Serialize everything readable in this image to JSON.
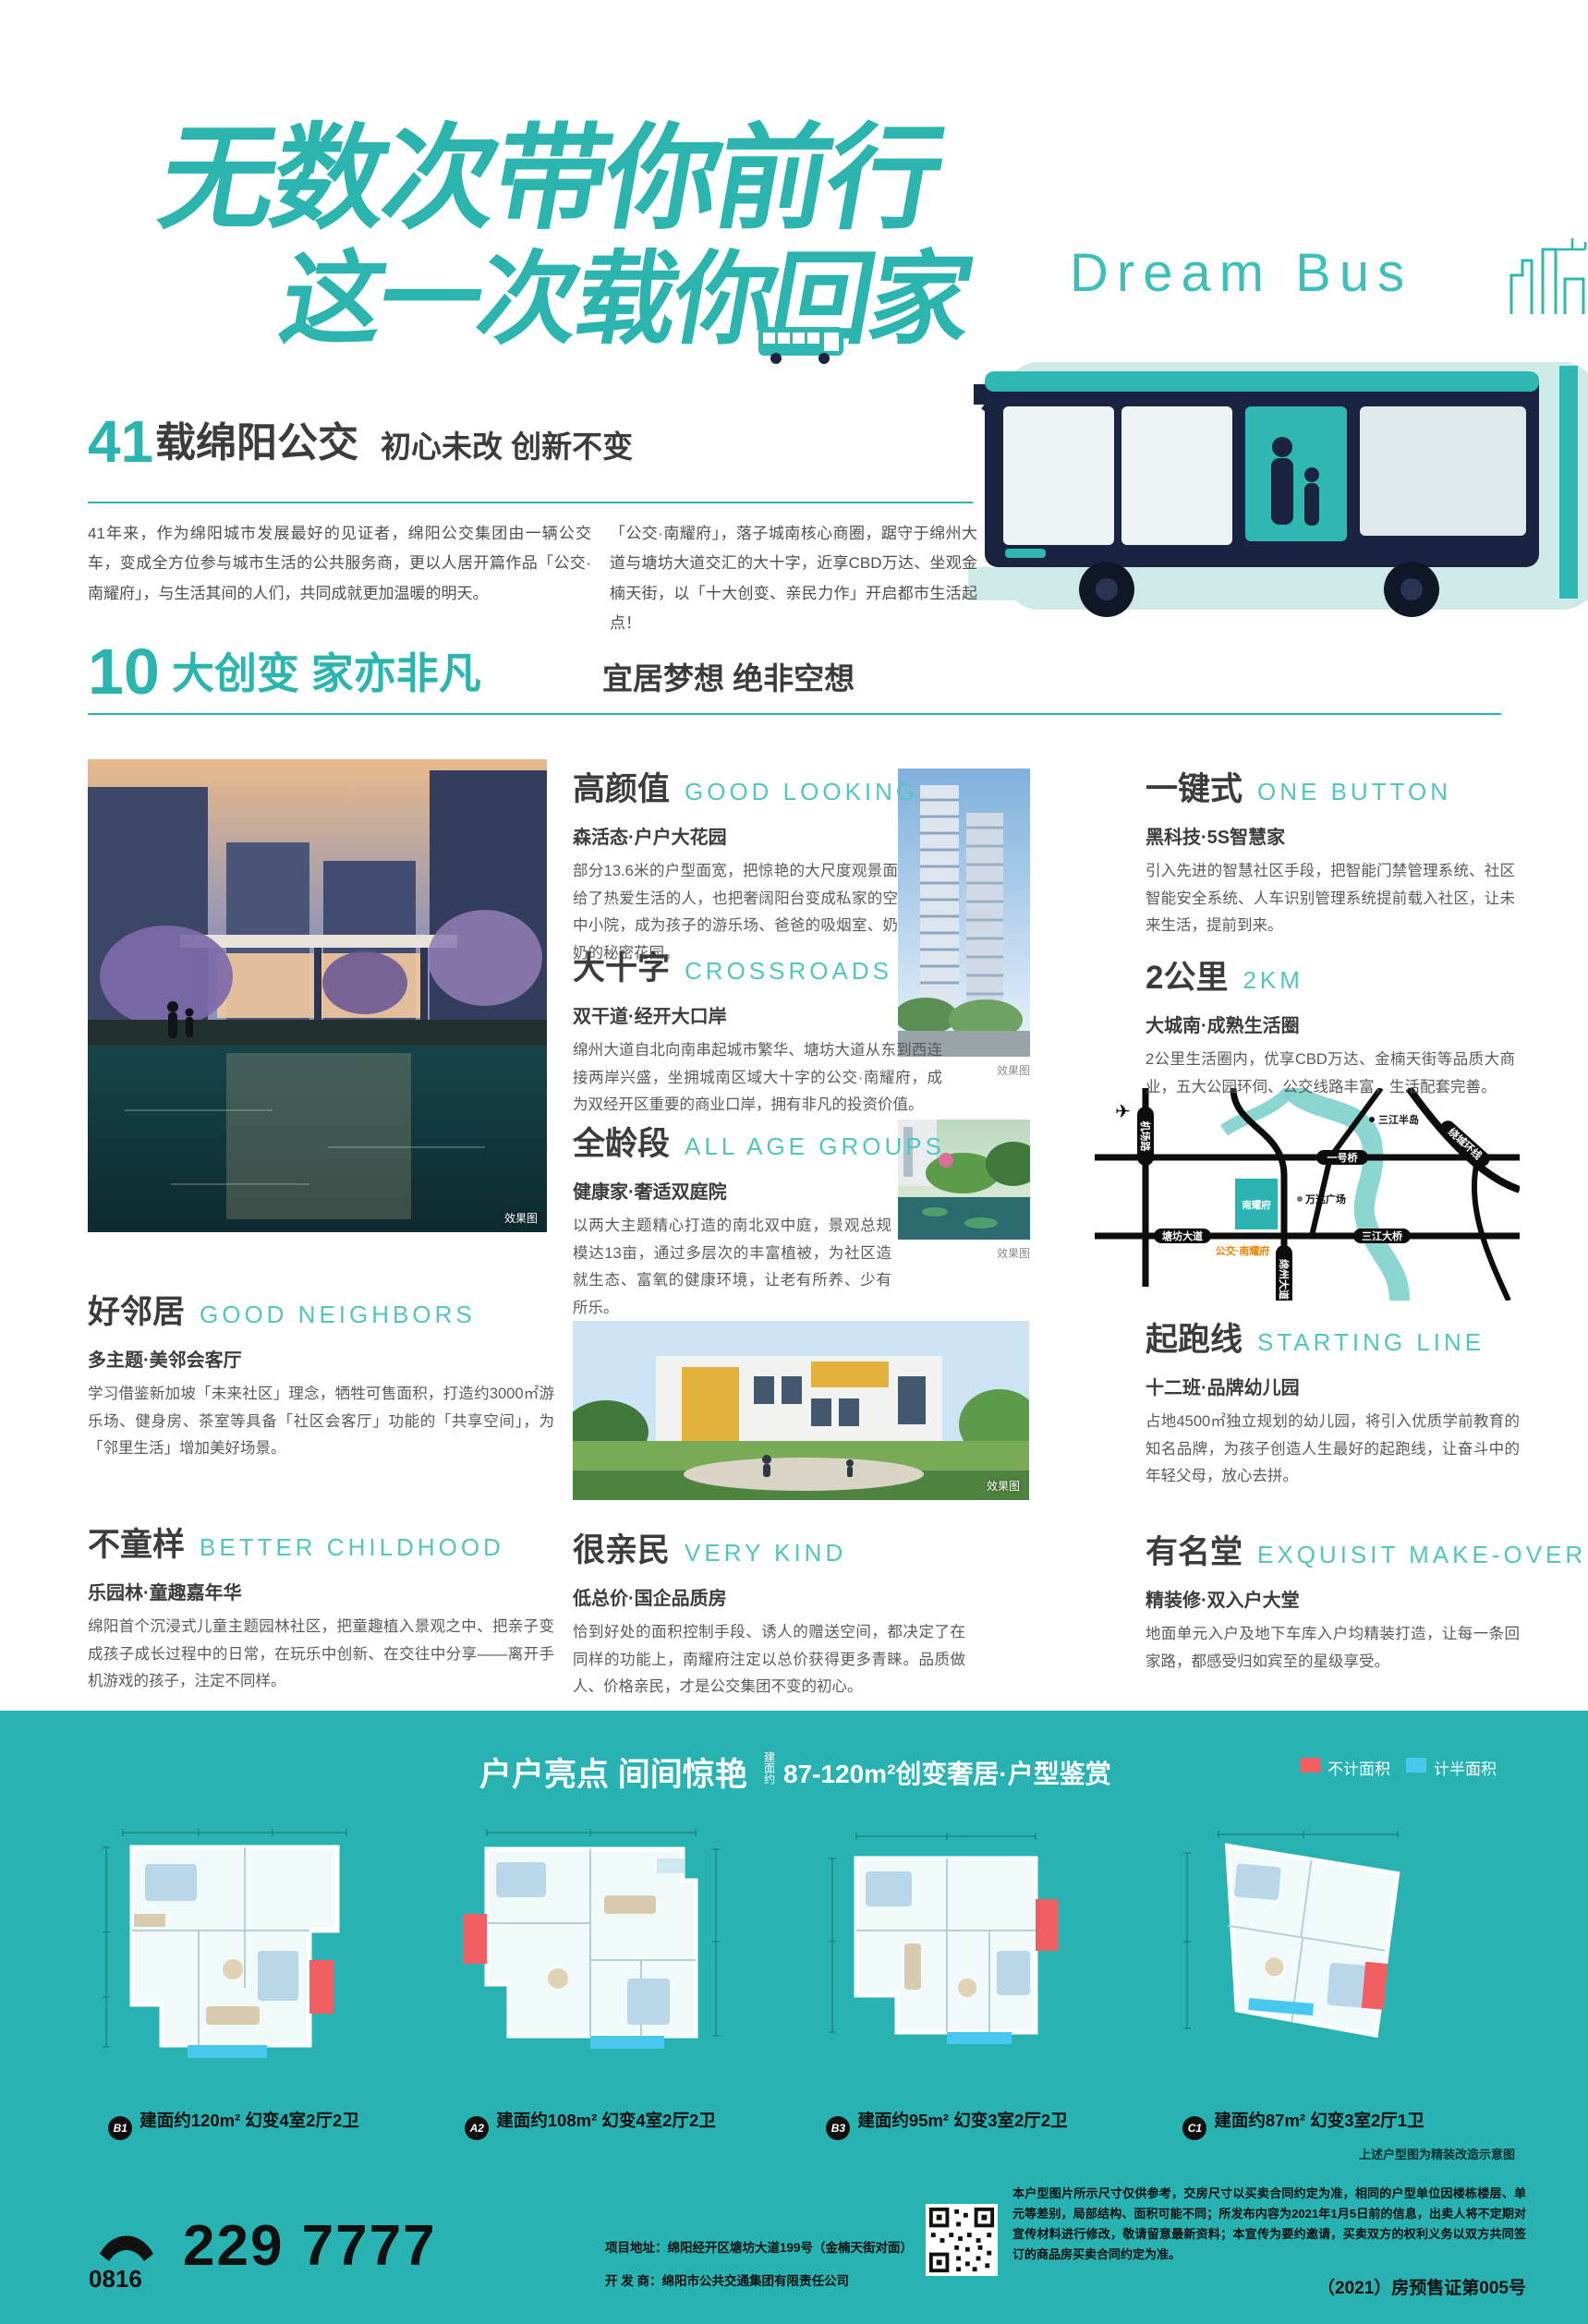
{
  "colors": {
    "teal": "#2BB5AE",
    "band_teal": "#29B2B2",
    "bus_navy": "#1A2440",
    "mint": "#CDEAE8",
    "legend_red": "#F25F63",
    "legend_cyan": "#49C8EF",
    "map_orange": "#F08300"
  },
  "icons": {
    "bus_small": "bus-icon",
    "bus_big": "dream-bus-illustration",
    "skyline": "city-skyline-icon",
    "plane": "airplane-icon",
    "phone": "phone-icon",
    "qr": "qr-code"
  },
  "hero": {
    "line1": "无数次带你前行",
    "line2": "这一次载你回家",
    "dream_bus": "Dream Bus"
  },
  "s41": {
    "num": "41",
    "title": "载绵阳公交",
    "subtitle": "初心未改 创新不变",
    "para_left": "41年来，作为绵阳城市发展最好的见证者，绵阳公交集团由一辆公交车，变成全方位参与城市生活的公共服务商，更以人居开篇作品「公交·南耀府」，与生活其间的人们，共同成就更加温暖的明天。",
    "para_right": "「公交·南耀府」，落子城南核心商圈，踞守于绵州大道与塘坊大道交汇的大十字，近享CBD万达、坐观金楠天街，以「十大创变、亲民力作」开启都市生活起点！"
  },
  "s10": {
    "num": "10",
    "title": "大创变  家亦非凡",
    "subtitle": "宜居梦想  绝非空想"
  },
  "captions": {
    "render": "效果图"
  },
  "features": [
    {
      "cn": "高颜值",
      "en": "GOOD  LOOKING",
      "sub": "森活态·户户大花园",
      "body": "部分13.6米的户型面宽，把惊艳的大尺度观景面给了热爱生活的人，也把奢阔阳台变成私家的空中小院，成为孩子的游乐场、爸爸的吸烟室、奶奶的秘密花园。"
    },
    {
      "cn": "大十字",
      "en": "CROSSROADS",
      "sub": "双干道·经开大口岸",
      "body": "绵州大道自北向南串起城市繁华、塘坊大道从东到西连接两岸兴盛，坐拥城南区域大十字的公交·南耀府，成为双经开区重要的商业口岸，拥有非凡的投资价值。"
    },
    {
      "cn": "一键式",
      "en": "ONE  BUTTON",
      "sub": "黑科技·5S智慧家",
      "body": "引入先进的智慧社区手段，把智能门禁管理系统、社区智能安全系统、人车识别管理系统提前载入社区，让未来生活，提前到来。"
    },
    {
      "cn": "2公里",
      "en": "2KM",
      "sub": "大城南·成熟生活圈",
      "body": "2公里生活圈内，优享CBD万达、金楠天街等品质大商业，五大公园环伺、公交线路丰富，生活配套完善。"
    },
    {
      "cn": "全龄段",
      "en": "ALL  AGE  GROUPS",
      "sub": "健康家·奢适双庭院",
      "body": "以两大主题精心打造的南北双中庭，景观总规模达13亩，通过多层次的丰富植被，为社区造就生态、富氧的健康环境，让老有所养、少有所乐。"
    },
    {
      "cn": "好邻居",
      "en": "GOOD  NEIGHBORS",
      "sub": "多主题·美邻会客厅",
      "body": "学习借鉴新加坡「未来社区」理念，牺牲可售面积，打造约3000㎡游乐场、健身房、茶室等具备「社区会客厅」功能的「共享空间」，为「邻里生活」增加美好场景。"
    },
    {
      "cn": "起跑线",
      "en": "STARTING  LINE",
      "sub": "十二班·品牌幼儿园",
      "body": "占地4500㎡独立规划的幼儿园，将引入优质学前教育的知名品牌，为孩子创造人生最好的起跑线，让奋斗中的年轻父母，放心去拼。"
    },
    {
      "cn": "不童样",
      "en": "BETTER  CHILDHOOD",
      "sub": "乐园林·童趣嘉年华",
      "body": "绵阳首个沉浸式儿童主题园林社区，把童趣植入景观之中、把亲子变成孩子成长过程中的日常，在玩乐中创新、在交往中分享——离开手机游戏的孩子，注定不同样。"
    },
    {
      "cn": "很亲民",
      "en": "VERY  KIND",
      "sub": "低总价·国企品质房",
      "body": "恰到好处的面积控制手段、诱人的赠送空间，都决定了在同样的功能上，南耀府注定以总价获得更多青睐。品质做人、价格亲民，才是公交集团不变的初心。"
    },
    {
      "cn": "有名堂",
      "en": "EXQUISIT  MAKE-OVER",
      "sub": "精装修·双入户大堂",
      "body": "地面单元入户及地下车库入户均精装打造，让每一条回家路，都感受归如宾至的星级享受。"
    }
  ],
  "map": {
    "roads": [
      "机场路",
      "一号桥",
      "绵州大道",
      "塘坊大道",
      "三江大桥",
      "绕城环线"
    ],
    "landmark": "三江半岛",
    "landmark2": "万达广场",
    "project": "公交·南耀府",
    "project_short": "南耀府"
  },
  "band": {
    "title": "户户亮点 间间惊艳",
    "area_prefix": "建面约",
    "area_title": "87-120m²创变奢居·户型鉴赏",
    "legend": [
      {
        "label": "不计面积",
        "color": "#F25F63"
      },
      {
        "label": "计半面积",
        "color": "#49C8EF"
      }
    ],
    "note": "上述户型图为精装改造示意图",
    "plans": [
      {
        "code": "B1",
        "label": "建面约120m² 幻变4室2厅2卫"
      },
      {
        "code": "A2",
        "label": "建面约108m² 幻变4室2厅2卫"
      },
      {
        "code": "B3",
        "label": "建面约95m² 幻变3室2厅2卫"
      },
      {
        "code": "C1",
        "label": "建面约87m² 幻变3室2厅1卫"
      }
    ]
  },
  "footer": {
    "area_code": "0816",
    "phone": "229 7777",
    "address_label": "项目地址：",
    "address": "绵阳经开区塘坊大道199号（金楠天街对面）",
    "developer_label": "开 发 商：",
    "developer": "绵阳市公共交通集团有限责任公司",
    "disclaimer": "本户型图片所示尺寸仅供参考，交房尺寸以买卖合同约定为准，相同的户型单位因楼栋楼层、单元等差别，局部结构、面积可能不同；所发布内容为2021年1月5日前的信息，出卖人将不定期对宣传材料进行修改，敬请留意最新资料；本宣传为要约邀请，买卖双方的权利义务以双方共同签订的商品房买卖合同约定为准。",
    "permit": "（2021）房预售证第005号"
  }
}
